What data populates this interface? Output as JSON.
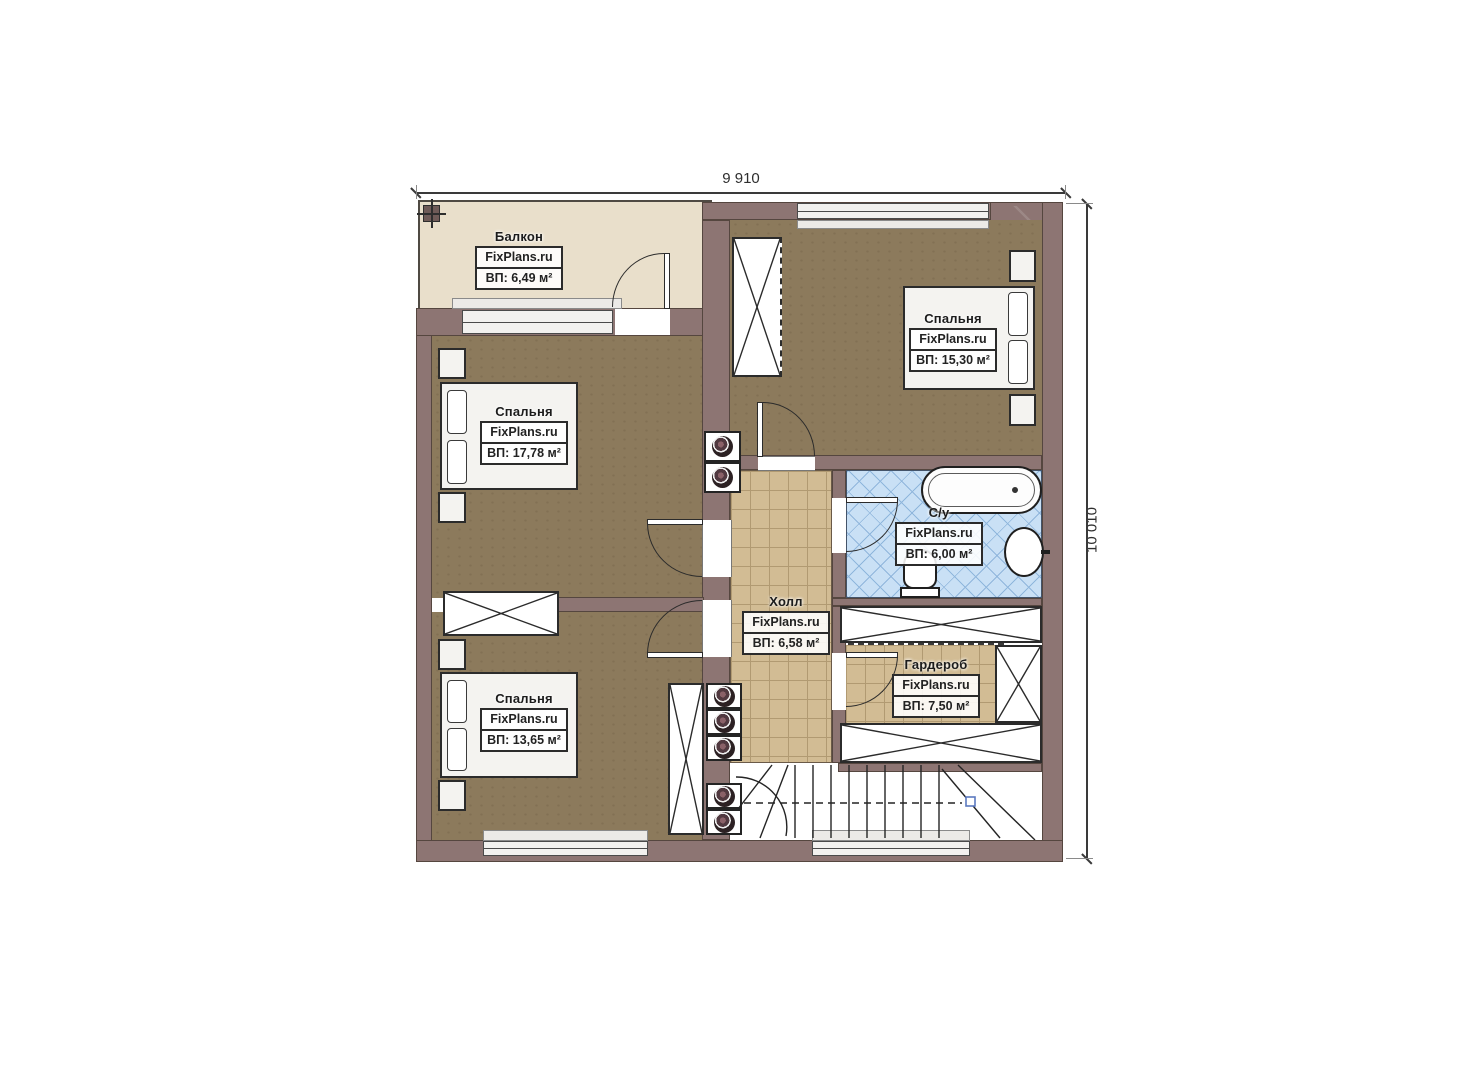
{
  "dimensions": {
    "width_label": "9 910",
    "height_label": "10 010"
  },
  "rooms": {
    "balcony": {
      "name": "Балкон",
      "brand": "FixPlans.ru",
      "area": "ВП: 6,49 м²"
    },
    "bedroom_top_right": {
      "name": "Спальня",
      "brand": "FixPlans.ru",
      "area": "ВП: 15,30 м²"
    },
    "bedroom_mid_left": {
      "name": "Спальня",
      "brand": "FixPlans.ru",
      "area": "ВП: 17,78 м²"
    },
    "bedroom_bottom_left": {
      "name": "Спальня",
      "brand": "FixPlans.ru",
      "area": "ВП: 13,65 м²"
    },
    "hall": {
      "name": "Холл",
      "brand": "FixPlans.ru",
      "area": "ВП: 6,58 м²"
    },
    "bathroom": {
      "name": "С/у",
      "brand": "FixPlans.ru",
      "area": "ВП: 6,00 м²"
    },
    "wardrobe": {
      "name": "Гардероб",
      "brand": "FixPlans.ru",
      "area": "ВП: 7,50 м²"
    }
  },
  "colors": {
    "wall": "#8d7573",
    "bedroom_floor": "#8c7a5c",
    "tile_floor": "#d2bc94",
    "bathroom_floor": "#c9e0f5",
    "balcony_floor": "#e9dfcb"
  }
}
